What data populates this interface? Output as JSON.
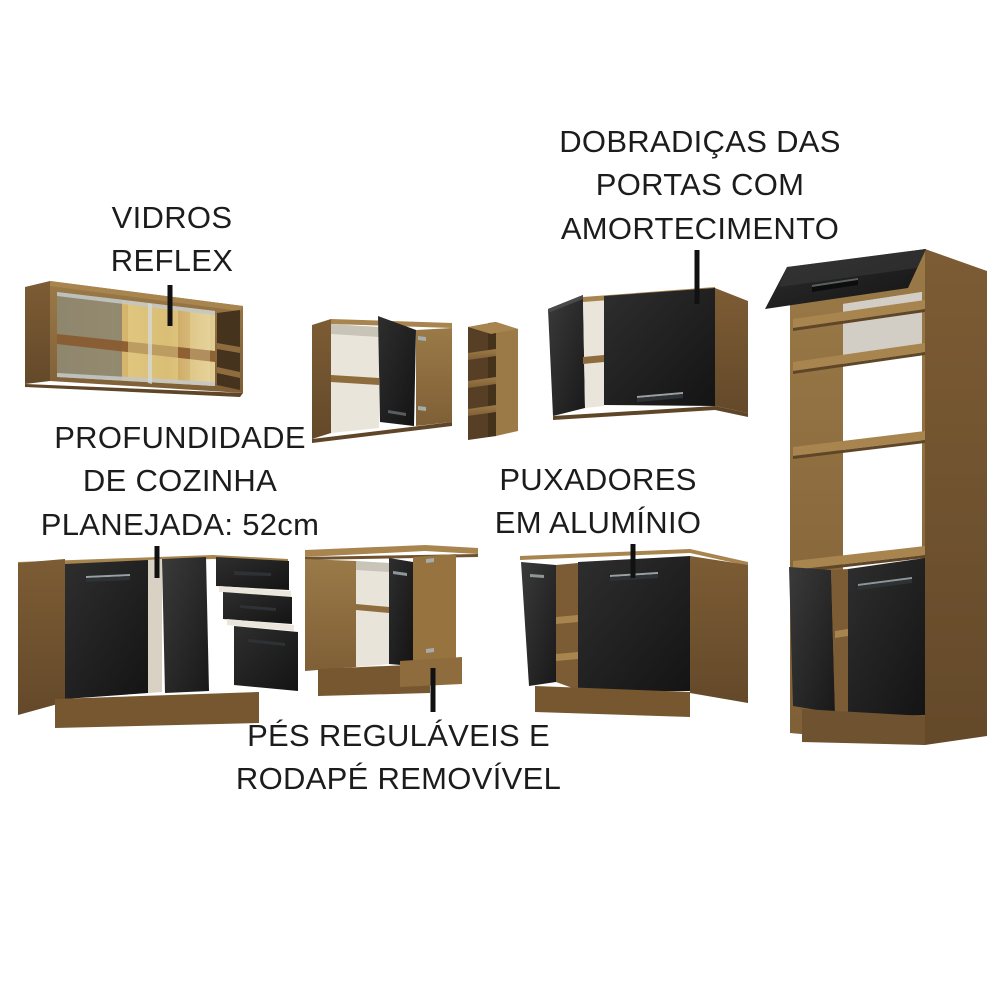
{
  "annotations": [
    {
      "id": "vidros-reflex",
      "label": "VIDROS\nREFLEX"
    },
    {
      "id": "dobradicas",
      "label": "DOBRADIÇAS DAS\nPORTAS COM\nAMORTECIMENTO"
    },
    {
      "id": "profundidade",
      "label": "PROFUNDIDADE\nDE COZINHA\nPLANEJADA: 52cm"
    },
    {
      "id": "puxadores",
      "label": "PUXADORES\nEM ALUMÍNIO"
    },
    {
      "id": "pes",
      "label": "PÉS REGULÁVEIS E\nRODAPÉ REMOVÍVEL"
    }
  ],
  "furniture": {
    "items": [
      {
        "name": "glass-wall-cabinet"
      },
      {
        "name": "corner-wall-cabinet"
      },
      {
        "name": "open-shelf-unit"
      },
      {
        "name": "wall-cabinet-two-doors"
      },
      {
        "name": "tall-oven-cabinet"
      },
      {
        "name": "base-cabinet-with-drawers"
      },
      {
        "name": "corner-base-cabinet"
      },
      {
        "name": "base-cabinet-two-doors"
      }
    ]
  },
  "colors": {
    "background": "#ffffff",
    "text": "#1c1c1c",
    "leader_line": "#111111",
    "wood_front": "#8f6c3e",
    "wood_side": "#6f5230",
    "wood_light": "#a8854f",
    "door_black": "#1f1f1f",
    "glass_amber": "#d8b96e",
    "aluminum_handle": "#9aa1a3",
    "interior_white": "#e9e5db"
  }
}
